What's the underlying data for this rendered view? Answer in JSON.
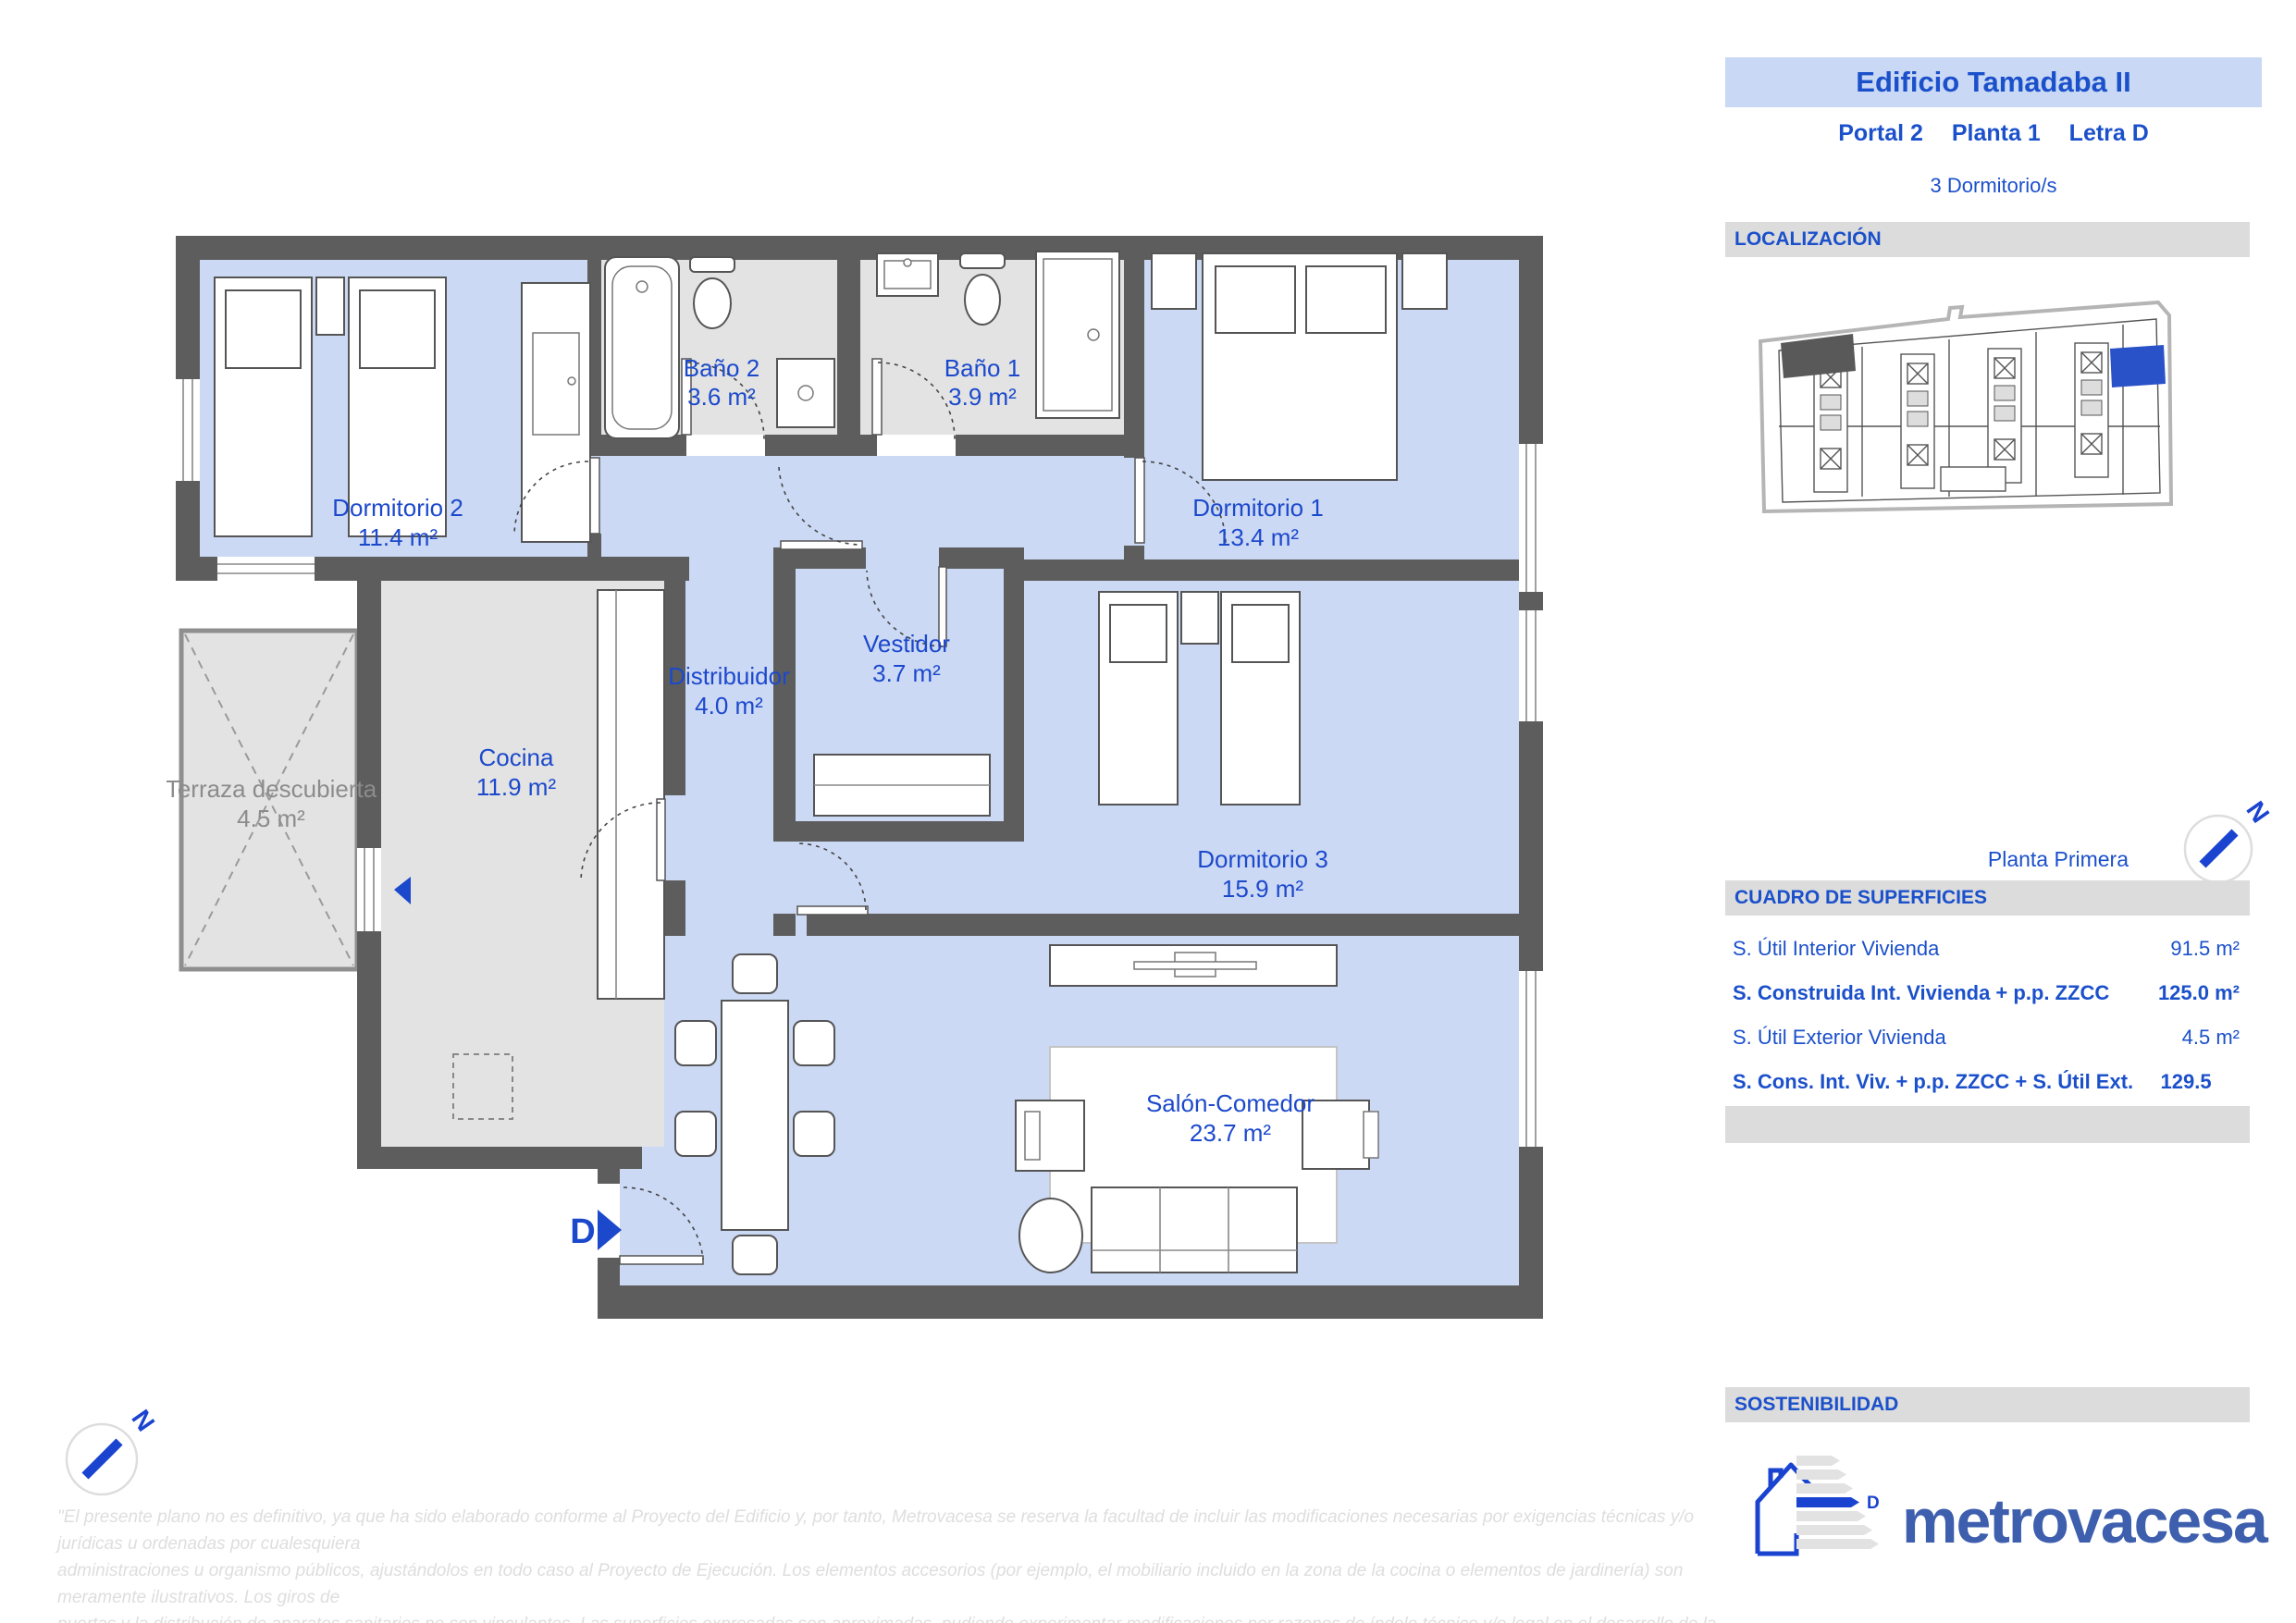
{
  "header": {
    "title": "Edificio Tamadaba II",
    "portal": "Portal 2",
    "planta": "Planta 1",
    "letra": "Letra D",
    "bedrooms": "3  Dormitorio/s"
  },
  "localizacion": {
    "label": "LOCALIZACIÓN"
  },
  "floor_label": "Planta Primera",
  "surfaces": {
    "title": "CUADRO DE SUPERFICIES",
    "rows": [
      {
        "label": "S. Útil Interior Vivienda",
        "value": "91.5 m²"
      },
      {
        "label": "S. Construida Int. Vivienda + p.p. ZZCC",
        "value": "125.0 m²"
      },
      {
        "label": "S. Útil Exterior Vivienda",
        "value": "4.5 m²"
      },
      {
        "label": "S. Cons. Int. Viv. + p.p. ZZCC + S. Útil Ext. Viv.",
        "value": "129.5 m²"
      }
    ]
  },
  "sostenibilidad": {
    "label": "SOSTENIBILIDAD",
    "energy_rating": "D"
  },
  "brand": {
    "logo_text": "metrovacesa"
  },
  "plan": {
    "entrance_label": "D",
    "compass_label": "N",
    "rooms": [
      {
        "name": "Dormitorio 2",
        "area": "11.4 m²"
      },
      {
        "name": "Baño 2",
        "area": "3.6 m²"
      },
      {
        "name": "Baño 1",
        "area": "3.9 m²"
      },
      {
        "name": "Dormitorio 1",
        "area": "13.4 m²"
      },
      {
        "name": "Vestidor",
        "area": "3.7 m²"
      },
      {
        "name": "Distribuidor",
        "area": "4.0 m²"
      },
      {
        "name": "Cocina",
        "area": "11.9 m²"
      },
      {
        "name": "Terraza descubierta",
        "area": "4.5 m²"
      },
      {
        "name": "Dormitorio 3",
        "area": "15.9 m²"
      },
      {
        "name": "Salón-Comedor",
        "area": "23.7 m²"
      }
    ]
  },
  "disclaimer": {
    "line1": "\"El presente plano no es definitivo, ya que ha sido elaborado conforme al Proyecto del Edificio y, por tanto, Metrovacesa se reserva la facultad de incluir las modificaciones necesarias por exigencias técnicas y/o jurídicas u ordenadas por cualesquiera",
    "line2": "administraciones u organismo públicos, ajustándolos en todo caso al Proyecto de Ejecución. Los elementos accesorios (por ejemplo, el mobiliario incluido en la zona de la cocina o elementos de jardinería) son meramente ilustrativos. Los giros de",
    "line3": "puertas y la distribución de aparatos sanitarios no son vinculantes. Las superficies expresadas son aproximadas, pudiendo experimentar modificaciones por razones de índole técnico y/o legal en el desarrollo de la ejecución de las obras\"."
  },
  "colors": {
    "accent_blue": "#1c49cc",
    "header_blue": "#1b50cb",
    "room_fill": "#ccd9f4",
    "service_fill": "#e3e3e3",
    "wall": "#5d5d5d",
    "bar_bg": "#dcdcdc",
    "title_bg": "#c9d8f4",
    "logo_blue": "#3e5fae",
    "highlight_unit": "#2a52c8"
  }
}
